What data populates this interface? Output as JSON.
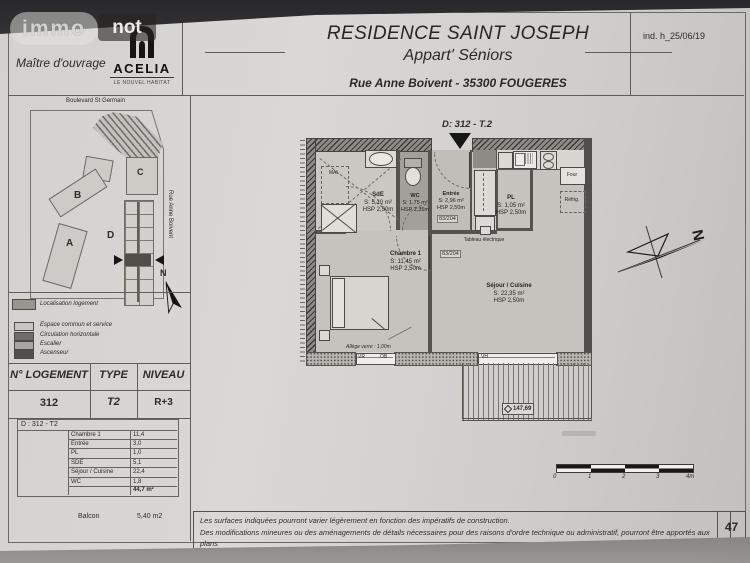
{
  "page": {
    "revision": "ind. h_25/06/19",
    "page_number": "47"
  },
  "watermark": {
    "immo": "immo",
    "not": "not"
  },
  "owner_block": {
    "label": "Maître d'ouvrage",
    "logo_name": "ACELIA",
    "logo_tagline": "LE NOUVEL HABITAT"
  },
  "title_block": {
    "title": "RESIDENCE SAINT JOSEPH",
    "subtitle": "Appart' Séniors",
    "address": "Rue Anne Boivent - 35300 FOUGERES"
  },
  "site_plan": {
    "street_top": "Boulevard St Germain",
    "street_right": "Rue Anne Boivent",
    "building_a": "A",
    "building_b": "B",
    "building_c": "C",
    "building_d": "D",
    "north": "N"
  },
  "legend": {
    "items": [
      {
        "label": "Localisation logement",
        "color": "#98968f"
      },
      {
        "label": "Espace commun et service",
        "color": "#c8c6c1"
      },
      {
        "label": "Circulation horizontale",
        "color": "#6f6d67"
      },
      {
        "label": "Escalier",
        "color": "#a8a6a0"
      },
      {
        "label": "Ascenseur",
        "color": "#514f4b"
      }
    ]
  },
  "unit_table": {
    "col1": "N° LOGEMENT",
    "col2": "TYPE",
    "col3": "NIVEAU",
    "val1": "312",
    "val2": "T2",
    "val3": "R+3"
  },
  "areas_table": {
    "title": "D : 312 - T2",
    "rows": [
      {
        "name": "Chambre 1",
        "value": "11,4"
      },
      {
        "name": "Entrée",
        "value": "3,0"
      },
      {
        "name": "PL",
        "value": "1,0"
      },
      {
        "name": "SDE",
        "value": "5,1"
      },
      {
        "name": "Séjour / Cuisine",
        "value": "22,4"
      },
      {
        "name": "WC",
        "value": "1,8"
      }
    ],
    "total": "44,7 m²",
    "balcon_label": "Balcon",
    "balcon_value": "5,40 m2"
  },
  "floor_plan": {
    "unit_label": "D: 312 - T.2",
    "north": "N",
    "rooms": {
      "sde": {
        "name": "SdE",
        "area": "S: 5,10 m²",
        "hsp": "HSP 2,50m"
      },
      "wc": {
        "name": "WC",
        "area": "S: 1,75 m²",
        "hsp": "HSP 2,35m"
      },
      "entree": {
        "name": "Entrée",
        "area": "S: 2,96 m²",
        "hsp": "HSP 2,50m"
      },
      "pl": {
        "name": "PL",
        "area": "S: 1,05 m²",
        "hsp": "HSP 2,50m"
      },
      "chambre": {
        "name": "Chambre 1",
        "area": "S: 11,45 m²",
        "hsp": "HSP 2,50m"
      },
      "sejour": {
        "name": "Séjour / Cuisine",
        "area": "S: 22,35 m²",
        "hsp": "HSP 2,50m"
      }
    },
    "annotations": {
      "mal": "MAL",
      "door_tag_1": "83/204",
      "door_tag_2": "83/204",
      "tableau_electrique": "Tableau électrique",
      "four": "Four",
      "refrig": "Réfrig.",
      "allege": "Allège verre : 1,00m",
      "window_vr": "VR",
      "window_ob": "OB",
      "window_vh": "VH",
      "level": "147,69"
    }
  },
  "scale_bar": {
    "t0": "0",
    "t1": "1",
    "t2": "2",
    "t3": "3",
    "t4": "4m"
  },
  "footer": {
    "line1": "Les surfaces indiquées pourront varier légèrement en fonction des impératifs de construction.",
    "line2": "Des modifications mineures ou des aménagements de détails nécessaires pour des raisons d'ordre technique ou administratif, pourront être apportés aux plans"
  }
}
